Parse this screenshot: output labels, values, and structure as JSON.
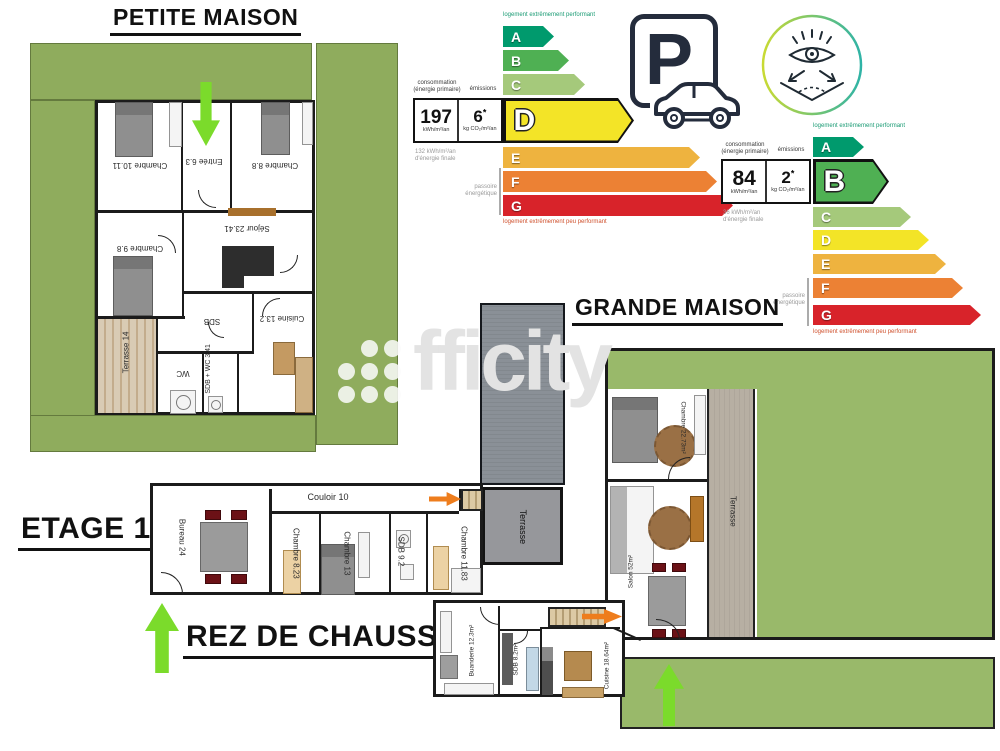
{
  "sections": {
    "petite": {
      "title": "PETITE MAISON"
    },
    "grande": {
      "title": "GRANDE MAISON"
    },
    "etage": {
      "title": "ETAGE 1"
    },
    "rez": {
      "title": "REZ DE CHAUSSEE"
    }
  },
  "watermark": {
    "text": "fficity"
  },
  "parking": {
    "letter": "P"
  },
  "dpe_petite": {
    "top_label": "logement extrêmement performant",
    "bottom_label": "logement extrêmement peu performant",
    "conso_line1": "consommation",
    "conso_line2": "(énergie primaire)",
    "emissions_label": "émissions",
    "kwh_value": "197",
    "kwh_unit": "kWh/m²/an",
    "co2_value": "6",
    "co2_star": "*",
    "co2_unit": "kg CO₂/m²/an",
    "final_line1": "132 kWh/m²/an",
    "final_line2": "d'énergie finale",
    "passoire_line1": "passoire",
    "passoire_line2": "énergétique",
    "grades": [
      "A",
      "B",
      "C",
      "D",
      "E",
      "F",
      "G"
    ],
    "highlighted_grade": "D"
  },
  "dpe_grande": {
    "top_label": "logement extrêmement performant",
    "bottom_label": "logement extrêmement peu performant",
    "conso_line1": "consommation",
    "conso_line2": "(énergie primaire)",
    "emissions_label": "émissions",
    "kwh_value": "84",
    "kwh_unit": "kWh/m²/an",
    "co2_value": "2",
    "co2_star": "*",
    "co2_unit": "kg CO₂/m²/an",
    "final_line1": "36 kWh/m²/an",
    "final_line2": "d'énergie finale",
    "passoire_line1": "passoire",
    "passoire_line2": "énergétique",
    "grades": [
      "A",
      "B",
      "C",
      "D",
      "E",
      "F",
      "G"
    ],
    "highlighted_grade": "B"
  },
  "rooms_petite": {
    "chambre_a": "Chambre 10.11",
    "entree": "Entrée 6.3",
    "chambre_b": "Chambre 8.8",
    "chambre_c": "Chambre 9.8",
    "sejour": "Séjour 23.41",
    "sdb": "SDB",
    "cuisine": "Cuisine 13.2",
    "terrasse": "Terrasse 14",
    "wc": "WC",
    "sdb_wc": "SDB + WC 3.41"
  },
  "rooms_etage": {
    "bureau": "Bureau 24",
    "couloir": "Couloir 10",
    "chambre_823": "Chambre 8.23",
    "chambre_13": "Chambre 13",
    "sdb": "SDB 9.2",
    "chambre_1183": "Chambre 11.83"
  },
  "rooms_rez": {
    "buanderie": "Buanderie 12.3m²",
    "sdb": "SDB 8.2m²",
    "cuisine": "Cuisine 18.64m²"
  },
  "rooms_grande": {
    "chambre": "Chambre 22.73m²",
    "terrasse_strip": "Terrasse",
    "terrasse_roof": "Terrasse",
    "salon": "Salon 52m²"
  },
  "colors": {
    "dpe_a": "#009a6d",
    "dpe_b": "#4fb053",
    "dpe_c": "#a5c97b",
    "dpe_d": "#f3e427",
    "dpe_e": "#eeb33f",
    "dpe_f": "#ec8134",
    "dpe_g": "#d8232a",
    "garden_green": "#8fac5d",
    "lawn_green": "#99b96a",
    "arrow_green": "#7bdb2b",
    "arrow_orange": "#ee7d1d",
    "roof_gray": "#8a9097",
    "terrace_beige": "#b7afa3"
  }
}
